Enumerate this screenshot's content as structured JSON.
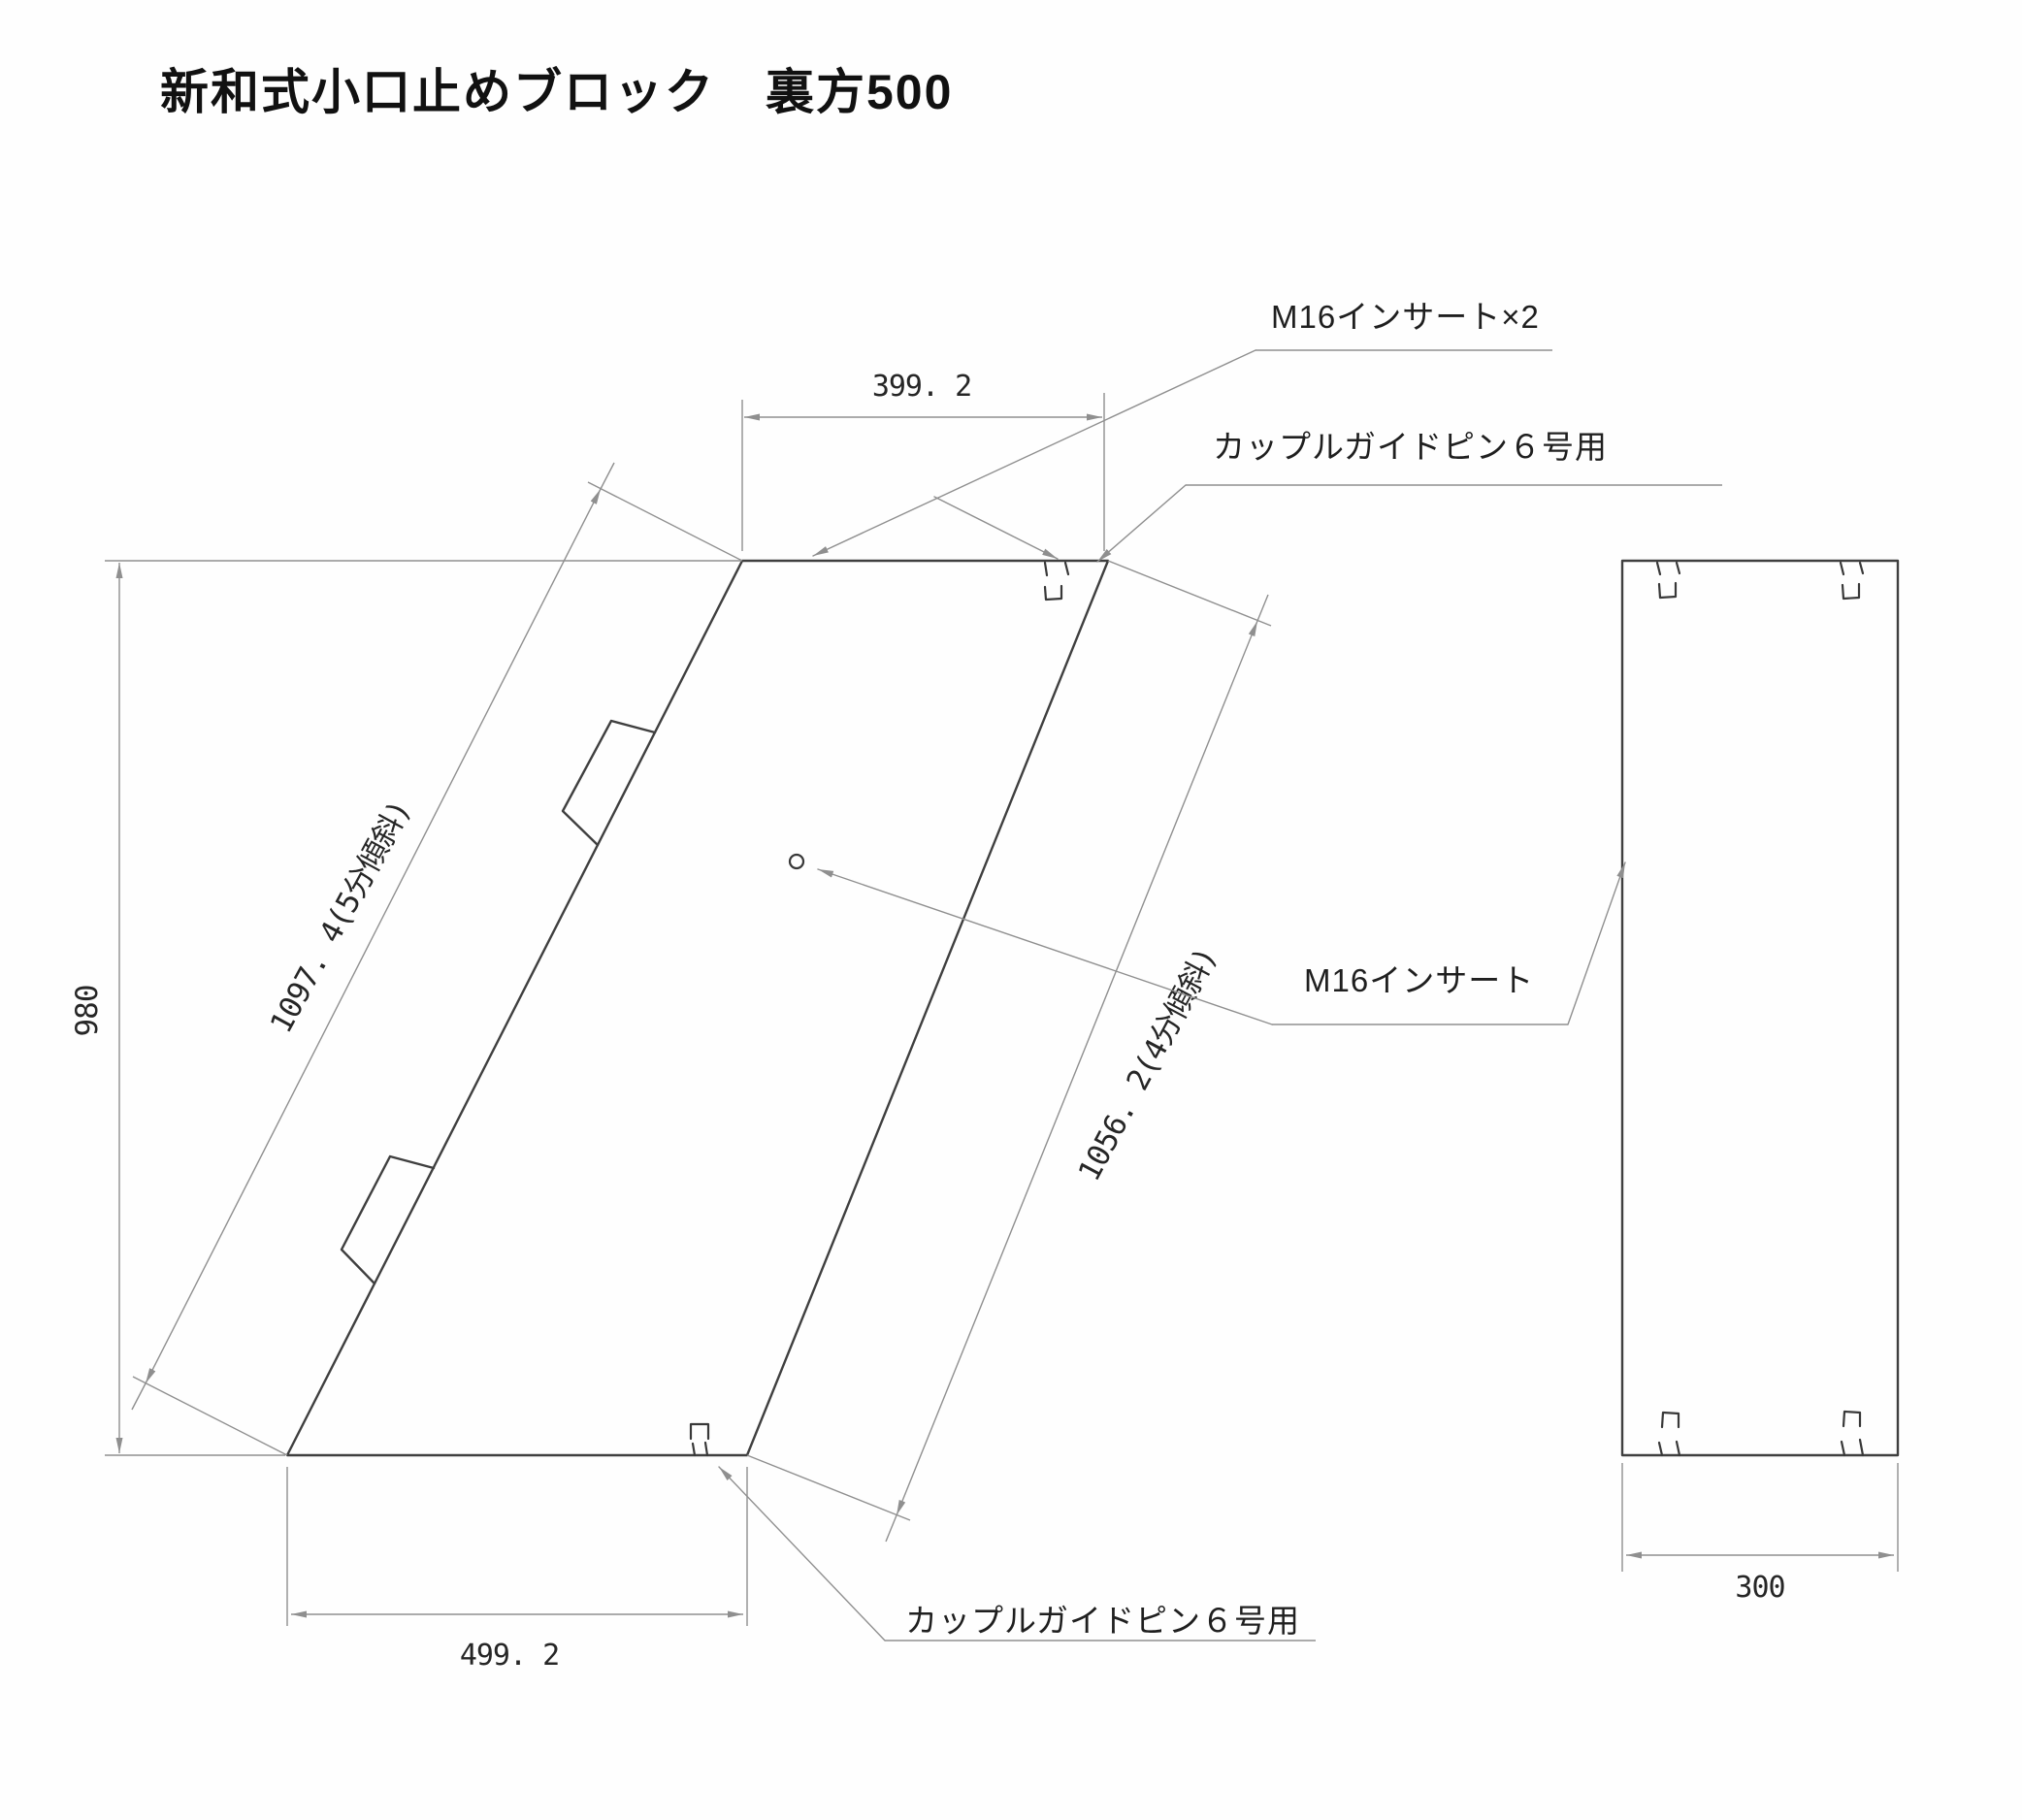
{
  "title": "新和式小口止めブロック　裏方500",
  "front_view": {
    "dimensions": {
      "top_width": "399. 2",
      "bottom_width": "499. 2",
      "height": "980",
      "left_edge_slope": "1097. 4(5分傾斜)",
      "right_edge_slope": "1056. 2(4分傾斜)"
    },
    "callouts": {
      "m16_insert_x2": "M16インサート×2",
      "couple_guide_pin_top": "カップルガイドピン６号用",
      "m16_insert": "M16インサート",
      "couple_guide_pin_bottom": "カップルガイドピン６号用"
    }
  },
  "side_view": {
    "dimensions": {
      "width": "300"
    }
  },
  "colors": {
    "background": "#fefefe",
    "geometry_line": "#3f3f3f",
    "dimension_line": "#8f8f8f",
    "text": "#1f1f1f"
  }
}
